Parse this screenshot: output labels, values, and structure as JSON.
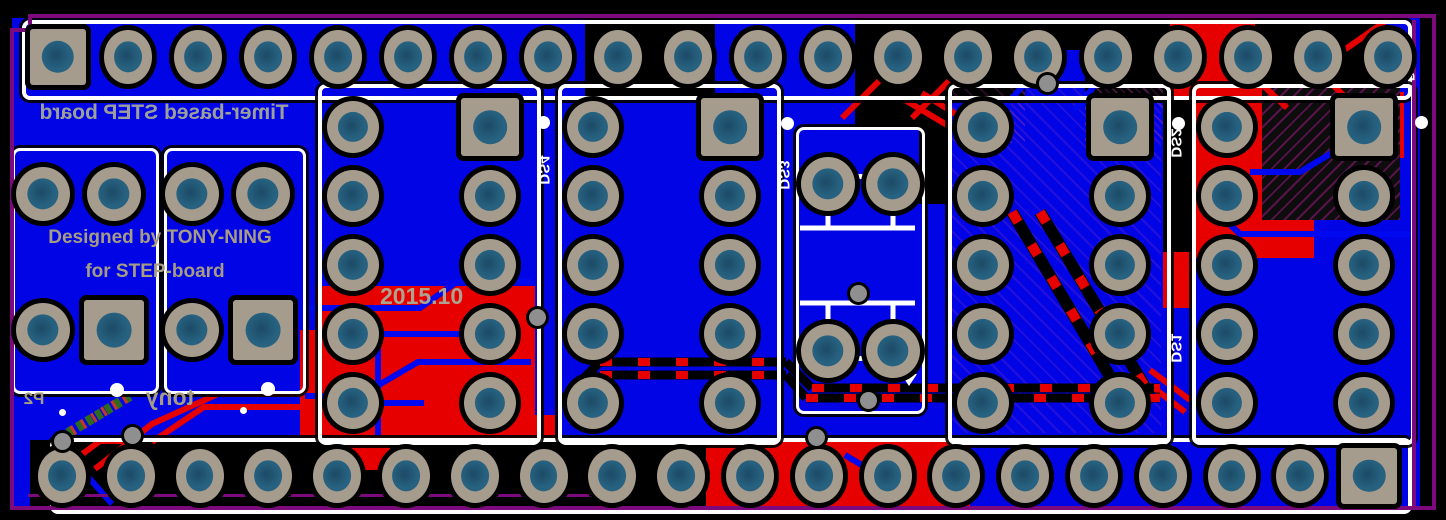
{
  "board": {
    "silkscreen_texts": {
      "title": "Timer-based STEP board",
      "credit1": "Designed by TONY-NING",
      "credit2": "for STEP-board",
      "date": "2015.10",
      "signature": "tony"
    },
    "designators": {
      "top_header": "P1",
      "bottom_header": "P2",
      "display1": "DS1",
      "display2": "DS2",
      "display3": "DS3",
      "display4": "DS4"
    },
    "colors": {
      "bottom_copper": "#0105e6",
      "top_copper": "#e60000",
      "silkscreen": "#ffffff",
      "silk_text_tan": "#a69c84",
      "board_outline": "#7c0a7c",
      "pad_ring": "#a69c8e",
      "drill_hole": "#27607f",
      "background": "#000000"
    }
  }
}
